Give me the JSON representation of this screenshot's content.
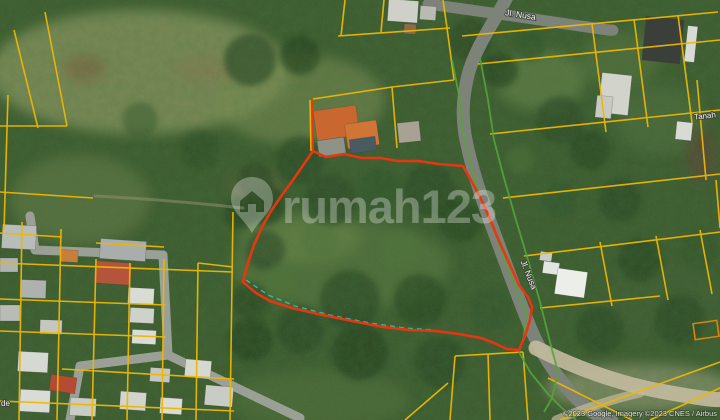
{
  "map": {
    "watermark": {
      "brand": "rumah123"
    },
    "road_labels": {
      "top": "Jl. Nusa",
      "side": "Jl. Nusa"
    },
    "area_labels": {
      "right_edge": "Tanah",
      "bottom_left_fragment": "de"
    },
    "attribution": "©2023 Google, Imagery ©2023 CNES / Airbus",
    "colors": {
      "parcel_line": "#eeb702",
      "boundary_highlight": "#e63612",
      "road_edge_line": "#55a43b",
      "survey_dash": "#3fc9b5",
      "watermark_fill": "rgba(255,255,255,0.30)"
    }
  }
}
